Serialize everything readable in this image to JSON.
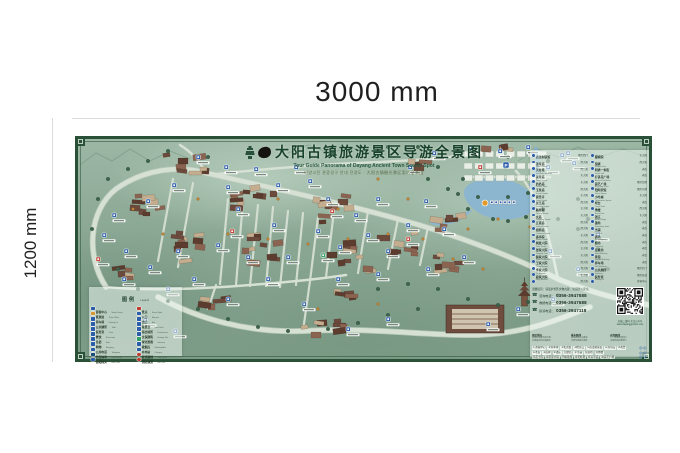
{
  "dimensions": {
    "width_label": "3000 mm",
    "height_label": "1200 mm"
  },
  "title_block": {
    "title_cn": "大阳古镇旅游景区导游全景图",
    "title_en": "Tour Guide Panorama of Dayang Ancient Town Scenic Spot",
    "title_intl": "대양고진 관광경구 안내 전경도 · 大阳古镇観光景区案内全景図"
  },
  "legend": {
    "title_cn": "图例",
    "title_en": "Legend",
    "columns": [
      [
        {
          "label": "游客中心",
          "sub": "Visitor Center",
          "color": "#2a5ca8"
        },
        {
          "label": "售票处",
          "sub": "Ticket Office",
          "color": "#d9952f"
        },
        {
          "label": "停车场",
          "sub": "Parking Lot",
          "color": "#2a5ca8"
        },
        {
          "label": "公共厕所",
          "sub": "Toilet",
          "color": "#2a5ca8"
        },
        {
          "label": "医务室",
          "sub": "Clinic",
          "color": "#2a5ca8"
        },
        {
          "label": "餐饮",
          "sub": "Restaurant",
          "color": "#2a5ca8"
        },
        {
          "label": "住宿",
          "sub": "Hotel",
          "color": "#2a5ca8"
        },
        {
          "label": "购物",
          "sub": "Shopping",
          "color": "#2a5ca8"
        },
        {
          "label": "公用电话",
          "sub": "Telephone",
          "color": "#2a5ca8"
        },
        {
          "label": "治安岗亭",
          "sub": "Police Kiosk",
          "color": "#1d4a7a"
        },
        {
          "label": "游船码头",
          "sub": "Boat Dock",
          "color": "#2a5ca8"
        }
      ],
      [
        {
          "label": "景点",
          "sub": "Scenic Spot",
          "color": "#c03a30"
        },
        {
          "label": "入口",
          "sub": "Entrance",
          "color": "#2a5ca8"
        },
        {
          "label": "出口",
          "sub": "Exit",
          "color": "#2a5ca8"
        },
        {
          "label": "观景台",
          "sub": "View Deck",
          "color": "#2a5ca8"
        },
        {
          "label": "演出场所",
          "sub": "Performance",
          "color": "#2a5ca8"
        },
        {
          "label": "文保建筑",
          "sub": "Heritage Site",
          "color": "#2a5ca8"
        },
        {
          "label": "绿化景观",
          "sub": "Greenery",
          "color": "#2f9e63"
        },
        {
          "label": "吸烟点",
          "sub": "Smoking Area",
          "color": "#2a5ca8"
        },
        {
          "label": "充电站",
          "sub": "Charging",
          "color": "#2a5ca8"
        },
        {
          "label": "游览路线",
          "sub": "Tour Route",
          "color": "#c03a30",
          "shape": "dot"
        },
        {
          "label": "消防通道",
          "sub": "Fire Lane",
          "color": "#c03a30",
          "shape": "dot"
        }
      ]
    ]
  },
  "directory": {
    "columns": [
      [
        {
          "name": "游客中心",
          "sub": "Visitor Center",
          "loc": "景区西门"
        },
        {
          "name": "古法制铁馆",
          "sub": "Iron Works Museum",
          "loc": "西大阳"
        },
        {
          "name": "汤帝庙",
          "sub": "Tangdi Temple",
          "loc": "西大阳"
        },
        {
          "name": "天柱塔",
          "sub": "Tianzhu Tower",
          "loc": "东大阳"
        },
        {
          "name": "关帝庙",
          "sub": "Guandi Temple",
          "loc": "东大阳"
        },
        {
          "name": "奶奶庙",
          "sub": "Nainai Temple",
          "loc": "西大阳"
        },
        {
          "name": "玉皇庙",
          "sub": "Yuhuang Temple",
          "loc": "东大阳"
        },
        {
          "name": "资圣寺",
          "sub": "Zisheng Temple",
          "loc": "西大阳"
        },
        {
          "name": "龙王庙",
          "sub": "Longwang Temple",
          "loc": "东大阳"
        },
        {
          "name": "魁星阁",
          "sub": "Kuixing Pavilion",
          "loc": "东大阳"
        },
        {
          "name": "文庙",
          "sub": "Confucian Temple",
          "loc": "西大阳"
        },
        {
          "name": "五道庙",
          "sub": "Wudao Temple",
          "loc": "西大阳"
        },
        {
          "name": "祖师庙",
          "sub": "Zushi Temple",
          "loc": "东大阳"
        },
        {
          "name": "香亭院",
          "sub": "Xiangting Yard",
          "loc": "西大阳"
        },
        {
          "name": "棋盘六院",
          "sub": "Qipan Courtyards",
          "loc": "东大阳"
        },
        {
          "name": "张家大院",
          "sub": "Zhang Mansion",
          "loc": "东大阳"
        },
        {
          "name": "裴家大院",
          "sub": "Pei Mansion",
          "loc": "西大阳"
        },
        {
          "name": "王家大院",
          "sub": "Wang Mansion",
          "loc": "西大阳"
        },
        {
          "name": "李家大院",
          "sub": "Li Mansion",
          "loc": "东大阳"
        },
        {
          "name": "段家大院",
          "sub": "Duan Mansion",
          "loc": "西大阳"
        }
      ],
      [
        {
          "name": "贡士院",
          "sub": "Gongshi Yard",
          "loc": "东大阳"
        },
        {
          "name": "都察院",
          "sub": "Ducha Yard",
          "loc": "西大阳"
        },
        {
          "name": "馆驿",
          "sub": "Ancient Post House",
          "loc": "老街"
        },
        {
          "name": "明清一条街",
          "sub": "Ming-Qing Street",
          "loc": "老街"
        },
        {
          "name": "打铁花广场",
          "sub": "Tiehua Square",
          "loc": "景区北侧"
        },
        {
          "name": "演艺广场",
          "sub": "Performance Square",
          "loc": "景区东侧"
        },
        {
          "name": "阳阿宾馆",
          "sub": "Yang'e Hotel",
          "loc": "东大阳"
        },
        {
          "name": "小吃城",
          "sub": "Snack Town",
          "loc": "老街"
        },
        {
          "name": "戏台",
          "sub": "Ancient Stage",
          "loc": "西大阳"
        },
        {
          "name": "绣楼",
          "sub": "Embroidery Tower",
          "loc": "东大阳"
        },
        {
          "name": "钱庄",
          "sub": "Old Bank",
          "loc": "老街"
        },
        {
          "name": "镖局",
          "sub": "Escort Agency",
          "loc": "老街"
        },
        {
          "name": "当铺",
          "sub": "Pawnshop",
          "loc": "老街"
        },
        {
          "name": "酒坊",
          "sub": "Wine Workshop",
          "loc": "老街"
        },
        {
          "name": "醋坊",
          "sub": "Vinegar Workshop",
          "loc": "老街"
        },
        {
          "name": "豆腐坊",
          "sub": "Tofu Workshop",
          "loc": "老街"
        },
        {
          "name": "茶馆",
          "sub": "Teahouse",
          "loc": "老街"
        },
        {
          "name": "停车场",
          "sub": "Parking Lot",
          "loc": "景区北门"
        },
        {
          "name": "公共厕所",
          "sub": "Public Toilet",
          "loc": "景区各处"
        },
        {
          "name": "医务室",
          "sub": "Clinic",
          "loc": "游客中心"
        }
      ]
    ]
  },
  "contact": {
    "tips": "温馨提示：请爱护景区文物古建，注意防火安全。",
    "phones": [
      {
        "label": "咨询电话",
        "number": "0356-3947588"
      },
      {
        "label": "救援电话",
        "number": "0356-3947688"
      },
      {
        "label": "投诉电话",
        "number": "0356-3947118"
      }
    ],
    "qr_caption1": "扫描二维码 关注公众号",
    "qr_caption2": "www.dayangguzhen.com"
  },
  "notes": [
    {
      "title": "景区地址",
      "lines": [
        "山西省晋城市泽州县",
        "大阳镇大阳古镇景区"
      ]
    },
    {
      "title": "乘车路线",
      "lines": [
        "晋城客运东站乘坐",
        "大阳专线直达景区"
      ]
    },
    {
      "title": "自驾路线",
      "lines": [
        "二广高速大阳出口",
        "沿景区指示牌前行"
      ]
    }
  ],
  "route_strip": [
    {
      "items": [
        "①游客中心",
        "②停车场",
        "③售票处",
        "④检票口",
        "⑤古法制铁馆",
        "⑥汤帝庙",
        "⑦戏台"
      ],
      "go": "◎◎"
    },
    {
      "items": [
        "⑧老街",
        "⑨馆驿",
        "⑩钱庄",
        "⑪镖局",
        "⑫当铺",
        "⑬酒坊",
        "⑭绣楼"
      ],
      "go": "◎◎"
    },
    {
      "items": [
        "⑮贡士院",
        "⑯张家大院",
        "⑰魁星阁",
        "⑱天柱塔",
        "⑲关帝庙",
        "⑳演艺广场"
      ],
      "go": "◎◎"
    }
  ],
  "map": {
    "colors": {
      "marker_blue": "#2a5ca8",
      "marker_red": "#c03a30",
      "marker_green": "#2f9e63",
      "marker_orange": "#e09a2d",
      "road": "#d6e0d3",
      "water": "#8cb6cf",
      "border": "#2a5138"
    },
    "markers": [
      [
        118,
        16,
        "b"
      ],
      [
        146,
        26,
        "b"
      ],
      [
        94,
        44,
        "b"
      ],
      [
        68,
        60,
        "b"
      ],
      [
        34,
        74,
        "b"
      ],
      [
        24,
        94,
        "b"
      ],
      [
        46,
        110,
        "b"
      ],
      [
        98,
        110,
        "b"
      ],
      [
        70,
        126,
        "b"
      ],
      [
        114,
        138,
        "b"
      ],
      [
        138,
        104,
        "b"
      ],
      [
        158,
        68,
        "b"
      ],
      [
        148,
        46,
        "b"
      ],
      [
        176,
        28,
        "b"
      ],
      [
        198,
        44,
        "b"
      ],
      [
        216,
        26,
        "b"
      ],
      [
        230,
        40,
        "b"
      ],
      [
        194,
        84,
        "b"
      ],
      [
        168,
        116,
        "b"
      ],
      [
        188,
        138,
        "b"
      ],
      [
        208,
        116,
        "b"
      ],
      [
        248,
        58,
        "b"
      ],
      [
        238,
        90,
        "b"
      ],
      [
        260,
        106,
        "b"
      ],
      [
        276,
        74,
        "b"
      ],
      [
        298,
        58,
        "b"
      ],
      [
        288,
        94,
        "b"
      ],
      [
        308,
        110,
        "b"
      ],
      [
        328,
        84,
        "b"
      ],
      [
        346,
        60,
        "b"
      ],
      [
        364,
        88,
        "b"
      ],
      [
        384,
        116,
        "b"
      ],
      [
        348,
        128,
        "b"
      ],
      [
        298,
        133,
        "b"
      ],
      [
        258,
        138,
        "b"
      ],
      [
        224,
        163,
        "b"
      ],
      [
        330,
        26,
        "b"
      ],
      [
        354,
        12,
        "b"
      ],
      [
        390,
        6,
        "b"
      ],
      [
        420,
        10,
        "b"
      ],
      [
        448,
        6,
        "b"
      ],
      [
        468,
        26,
        "b"
      ],
      [
        488,
        12,
        "b"
      ],
      [
        470,
        110,
        "b"
      ],
      [
        498,
        128,
        "b"
      ],
      [
        518,
        93,
        "b"
      ],
      [
        473,
        158,
        "b"
      ],
      [
        438,
        168,
        "b"
      ],
      [
        408,
        183,
        "b"
      ],
      [
        308,
        178,
        "b"
      ],
      [
        268,
        188,
        "b"
      ],
      [
        148,
        158,
        "b"
      ],
      [
        88,
        148,
        "b"
      ],
      [
        44,
        138,
        "b"
      ],
      [
        482,
        14,
        "b"
      ],
      [
        494,
        22,
        "b"
      ],
      [
        65,
        179,
        "b"
      ],
      [
        95,
        190,
        "b"
      ],
      [
        152,
        90,
        "r"
      ],
      [
        252,
        70,
        "r"
      ],
      [
        328,
        98,
        "r"
      ],
      [
        18,
        118,
        "r"
      ],
      [
        400,
        26,
        "r"
      ],
      [
        243,
        114,
        "g"
      ]
    ]
  }
}
